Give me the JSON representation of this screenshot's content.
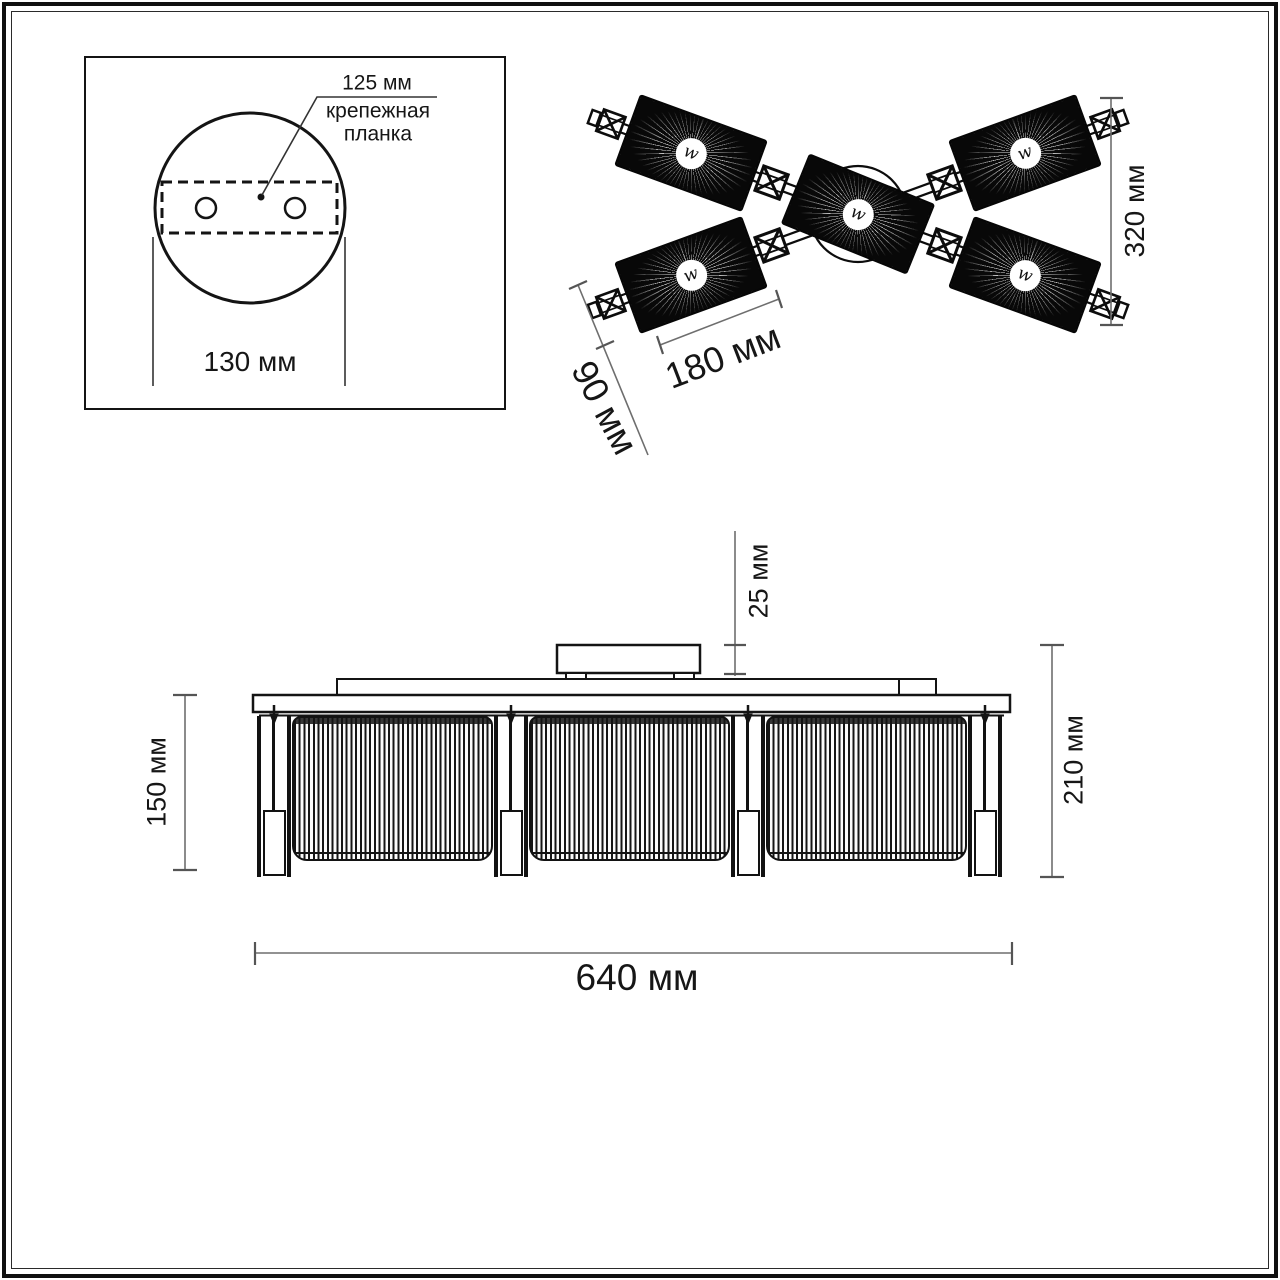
{
  "colors": {
    "ink": "#111111",
    "dimension_line": "#6e6e6e",
    "text": "#1a1a1a",
    "background": "#ffffff",
    "shade_fill": "#0a0a0a"
  },
  "mount_detail": {
    "dim_plate": "125 мм",
    "plate_label_line1": "крепежная",
    "plate_label_line2": "планка",
    "dim_canopy_diameter": "130 мм"
  },
  "top_view": {
    "dim_vertical_span": "320 мм",
    "dim_shade_length": "180 мм",
    "dim_shade_width": "90 мм",
    "bulb_symbol": "w"
  },
  "side_view": {
    "dim_shade_height": "150 мм",
    "dim_canopy_height": "25 мм",
    "dim_total_height": "210 мм",
    "dim_total_width": "640 мм"
  }
}
